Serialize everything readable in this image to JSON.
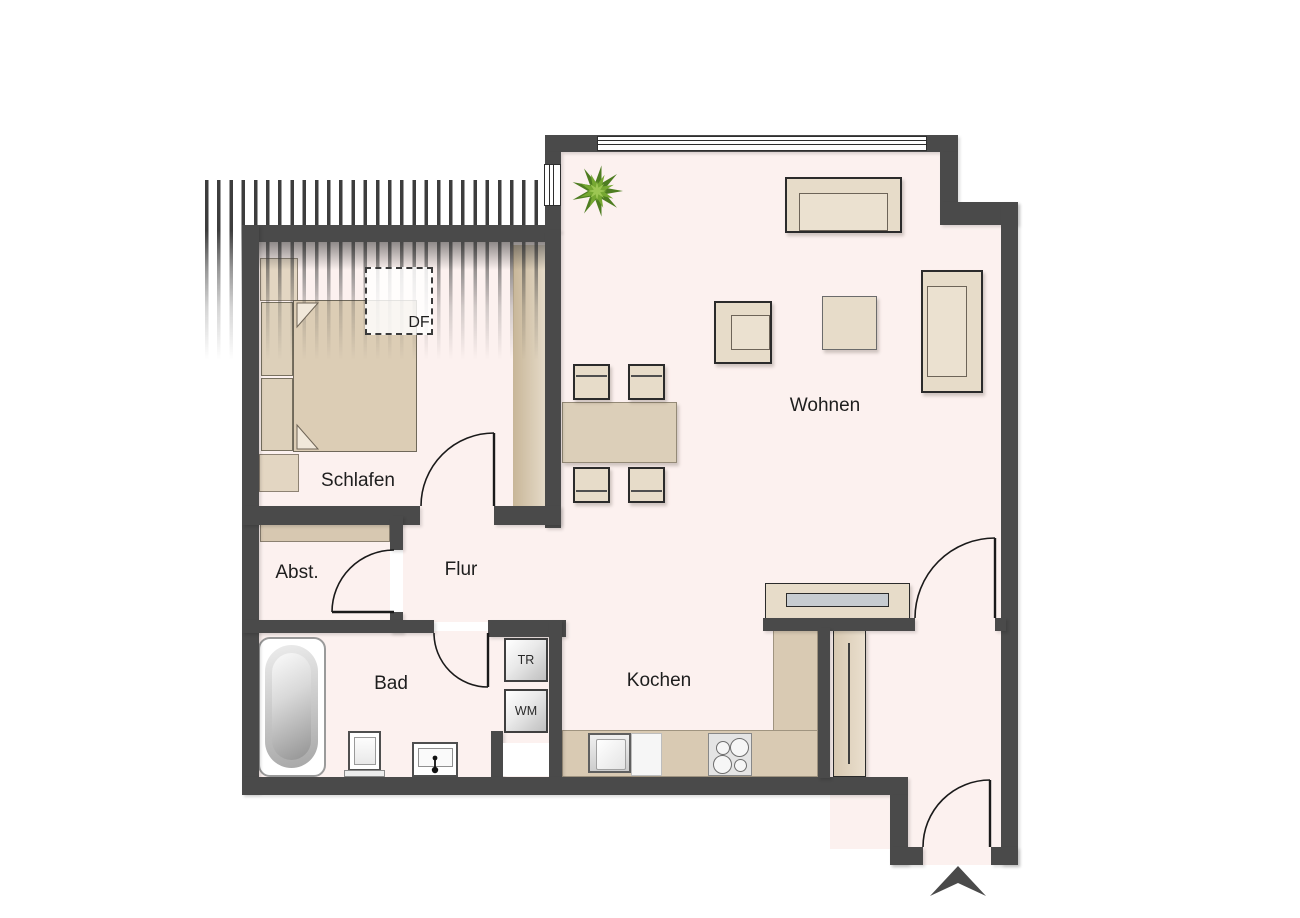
{
  "rooms": {
    "schlafen": {
      "label": "Schlafen"
    },
    "wohnen": {
      "label": "Wohnen"
    },
    "flur": {
      "label": "Flur"
    },
    "abstellraum": {
      "label": "Abst."
    },
    "bad": {
      "label": "Bad"
    },
    "kochen": {
      "label": "Kochen"
    }
  },
  "markers": {
    "dachfenster": {
      "label": "DF"
    },
    "trockner": {
      "label": "TR"
    },
    "waschmaschine": {
      "label": "WM"
    }
  },
  "icons": {
    "plant": "star-shaped potted plant, green layered leaves",
    "entrance_arrow": "dark chevron arrow marking apartment entrance",
    "door_swing": "quarter-circle door swing arcs",
    "cooktop": "four burner circles",
    "faucet": "two dots joined by a line on washbasin"
  },
  "colors": {
    "wall": "#4a4a4a",
    "floor": "#fcf1ef",
    "furniture": "#e7dcc9",
    "counter": "#d9cab3",
    "appliance_gray": "#c7ccd1",
    "plant_dark": "#4e7d21",
    "plant_mid": "#76a832",
    "plant_light": "#9cc653",
    "outline": "#2b2b2b"
  }
}
